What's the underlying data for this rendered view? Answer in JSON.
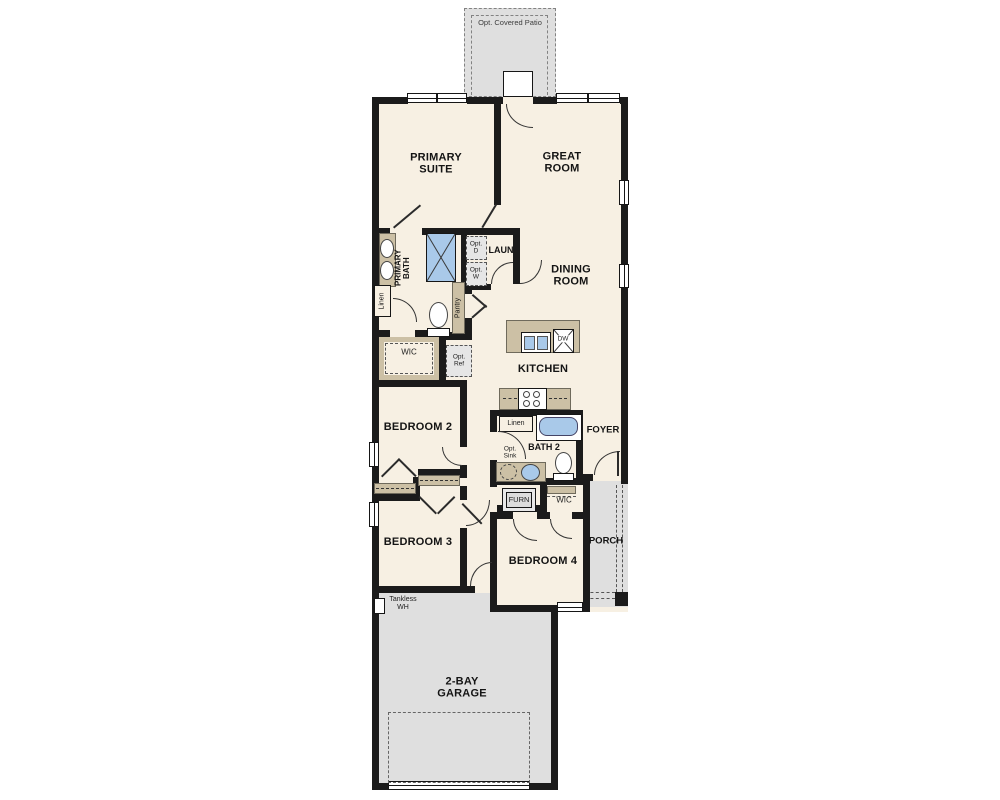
{
  "floorplan": {
    "labels": {
      "covered_patio": "Opt. Covered Patio",
      "primary_suite": "PRIMARY SUITE",
      "great_room": "GREAT ROOM",
      "primary_bath": "PRIMARY BATH",
      "laundry": "LAUN",
      "opt_dryer": "Opt. D",
      "opt_washer": "Opt. W",
      "dining_room": "DINING ROOM",
      "linen_primary": "Linen",
      "pantry": "Pantry",
      "wic_primary": "WIC",
      "opt_ref": "Opt. Ref",
      "kitchen": "KITCHEN",
      "dishwasher": "DW",
      "bedroom2": "BEDROOM 2",
      "linen_hall": "Linen",
      "bath2": "BATH 2",
      "foyer": "FOYER",
      "opt_sink": "Opt. Sink",
      "furnace": "FURN",
      "wic_bedroom4": "WIC",
      "bedroom3": "BEDROOM 3",
      "bedroom4": "BEDROOM 4",
      "porch": "PORCH",
      "tankless_wh": "Tankless WH",
      "garage": "2-BAY GARAGE"
    },
    "colors": {
      "floor": "#f7f0e3",
      "wall": "#1b1b1b",
      "outdoor": "#dfdfdf",
      "casework": "#ccc0a5",
      "fixture_blue": "#a9c9e9"
    }
  }
}
